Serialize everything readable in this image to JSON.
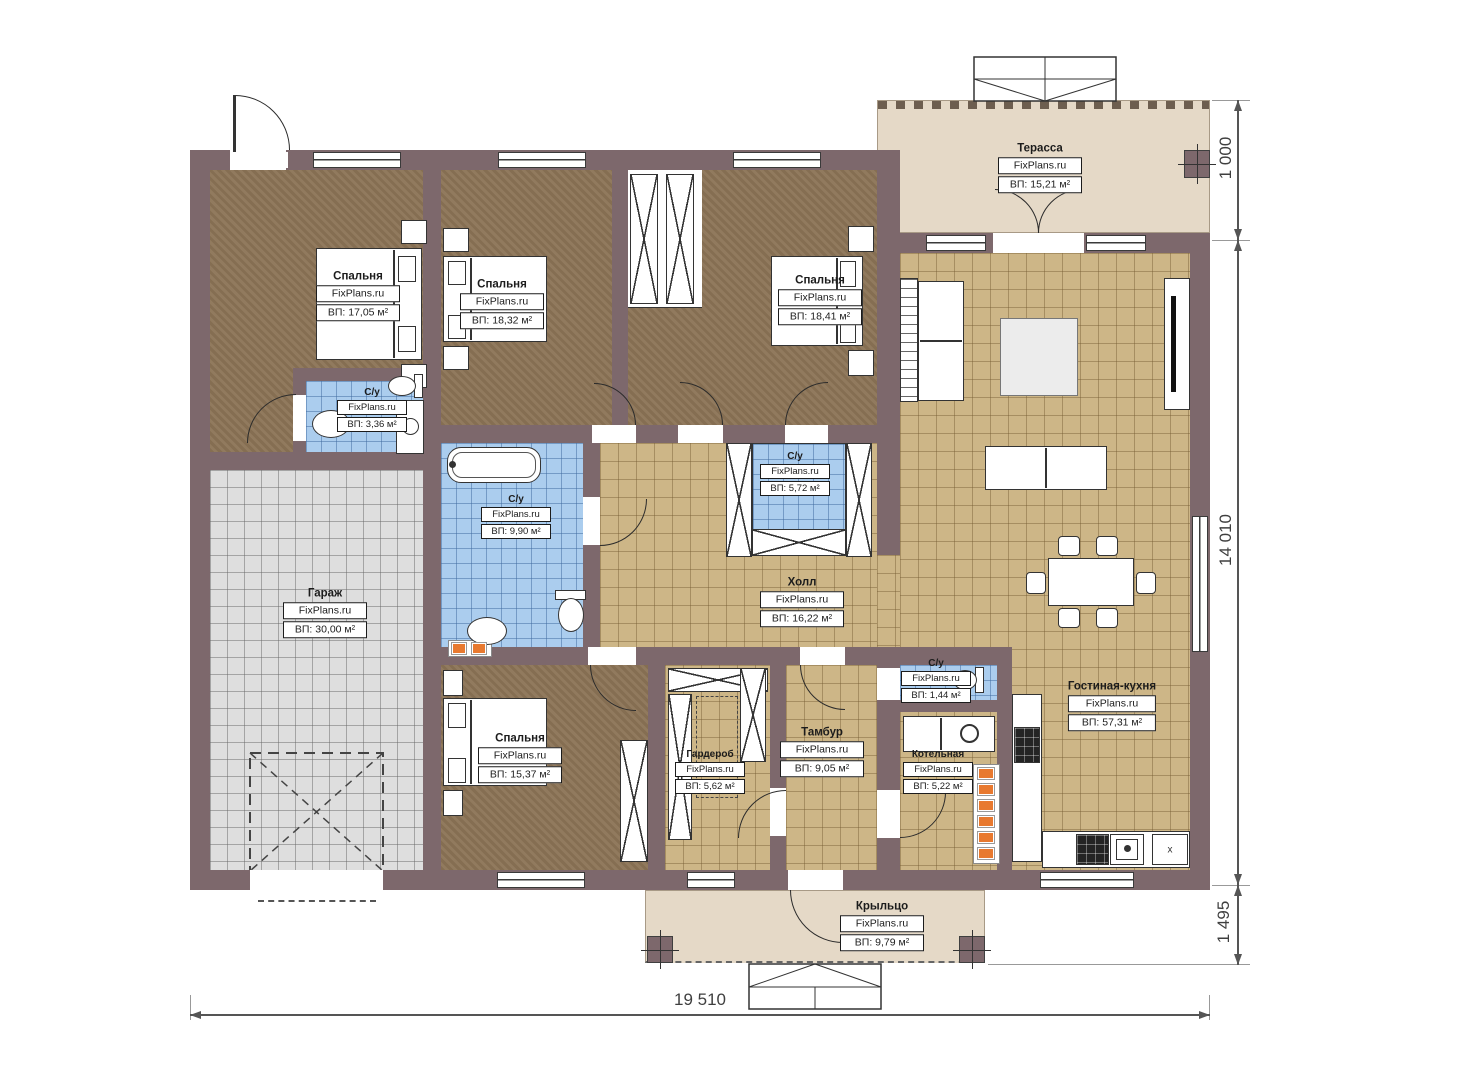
{
  "watermark": "FixPlans.ru",
  "rooms": {
    "bedroom1": {
      "name": "Спальня",
      "area": "ВП: 17,05 м²"
    },
    "bedroom2": {
      "name": "Спальня",
      "area": "ВП: 18,32 м²"
    },
    "bedroom3": {
      "name": "Спальня",
      "area": "ВП: 18,41 м²"
    },
    "bedroom4": {
      "name": "Спальня",
      "area": "ВП: 15,37 м²"
    },
    "terrace": {
      "name": "Терасса",
      "area": "ВП: 15,21 м²"
    },
    "su_bedroom1": {
      "name": "С/у",
      "area": "ВП: 3,36 м²"
    },
    "su_main": {
      "name": "С/у",
      "area": "ВП: 9,90 м²"
    },
    "su_bedroom3": {
      "name": "С/у",
      "area": "ВП: 5,72 м²"
    },
    "su_tambour": {
      "name": "С/у",
      "area": "ВП: 1,44 м²"
    },
    "garage": {
      "name": "Гараж",
      "area": "ВП: 30,00 м²"
    },
    "hall": {
      "name": "Холл",
      "area": "ВП: 16,22 м²"
    },
    "wardrobe": {
      "name": "Гардероб",
      "area": "ВП: 5,62 м²"
    },
    "tambour": {
      "name": "Тамбур",
      "area": "ВП: 9,05 м²"
    },
    "boiler": {
      "name": "Котельная",
      "area": "ВП: 5,22 м²"
    },
    "living_kitchen": {
      "name": "Гостиная-кухня",
      "area": "ВП: 57,31 м²"
    },
    "porch": {
      "name": "Крыльцо",
      "area": "ВП: 9,79 м²"
    }
  },
  "dimensions": {
    "bottom_width": "19 510",
    "right_height": "14 010",
    "terrace_depth": "1 000",
    "porch_depth": "1 495"
  },
  "labels": {
    "x_mark": "x"
  },
  "colors": {
    "wall": "#7d686c",
    "bedroom_floor": "#8d7557",
    "tile_floor": "#cdb687",
    "bath_floor": "#abcdee",
    "garage_floor": "#dedede",
    "terrace_floor": "#e5d9c7",
    "vent_orange": "#e8792f"
  }
}
